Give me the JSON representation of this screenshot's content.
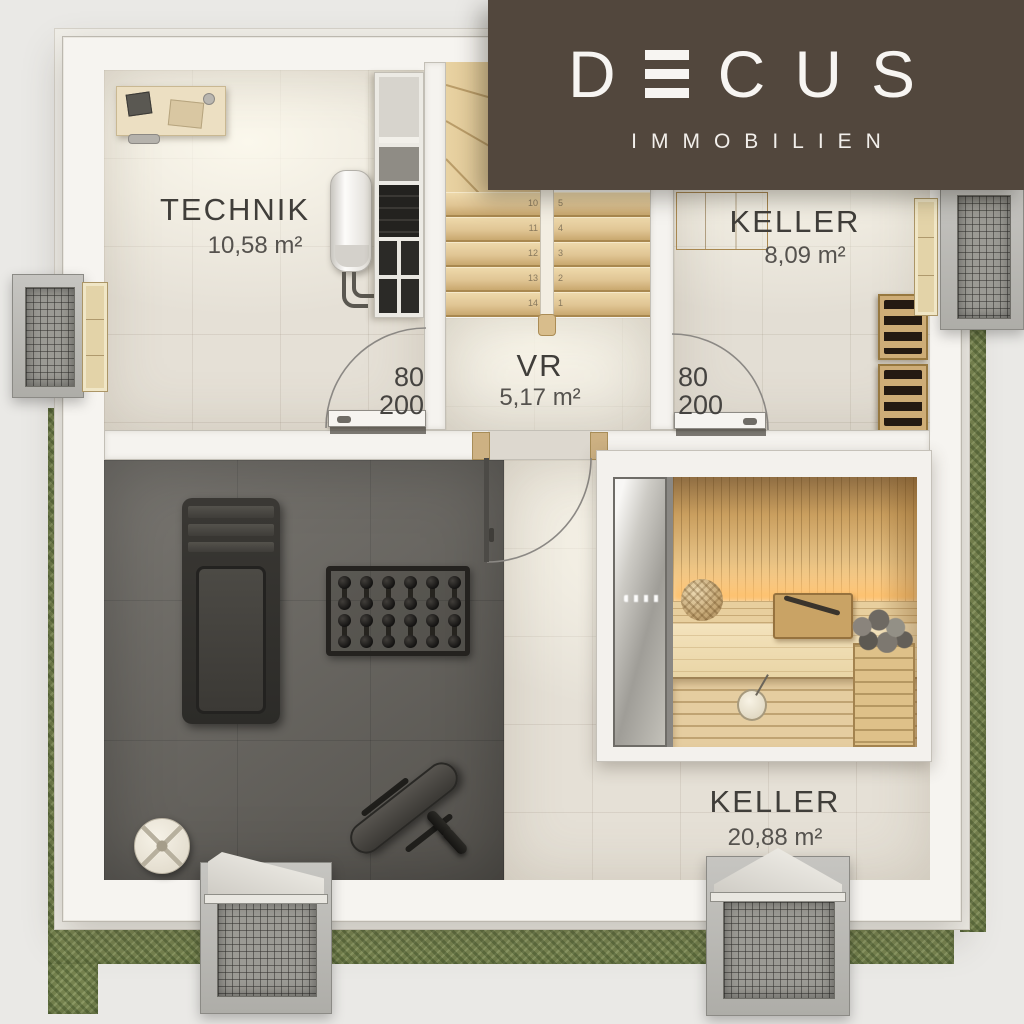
{
  "brand": {
    "letters": [
      "D",
      "CUS"
    ],
    "subtitle": "IMMOBILIEN",
    "panel_color": "#52473d",
    "text_color": "#f7f5f2"
  },
  "rooms": {
    "technik": {
      "label": "TECHNIK",
      "area": "10,58 m²"
    },
    "keller_small": {
      "label": "KELLER",
      "area": "8,09 m²"
    },
    "vr": {
      "label": "VR",
      "area": "5,17 m²"
    },
    "keller_large": {
      "label": "KELLER",
      "area": "20,88 m²"
    }
  },
  "doors": {
    "technik_door": {
      "width": "80",
      "height": "200"
    },
    "keller_small_door": {
      "width": "80",
      "height": "200"
    }
  },
  "stairs": {
    "left_numbers": [
      "10",
      "11",
      "12",
      "13",
      "14"
    ],
    "right_numbers": [
      "5",
      "4",
      "3",
      "2",
      "1"
    ]
  },
  "colors": {
    "wall": "#f5f3ef",
    "floor_tile": "#e5e0d6",
    "gym_floor": "#67645e",
    "wood": "#dcc094",
    "grass": "#76834f",
    "label_text": "#403e3a"
  }
}
